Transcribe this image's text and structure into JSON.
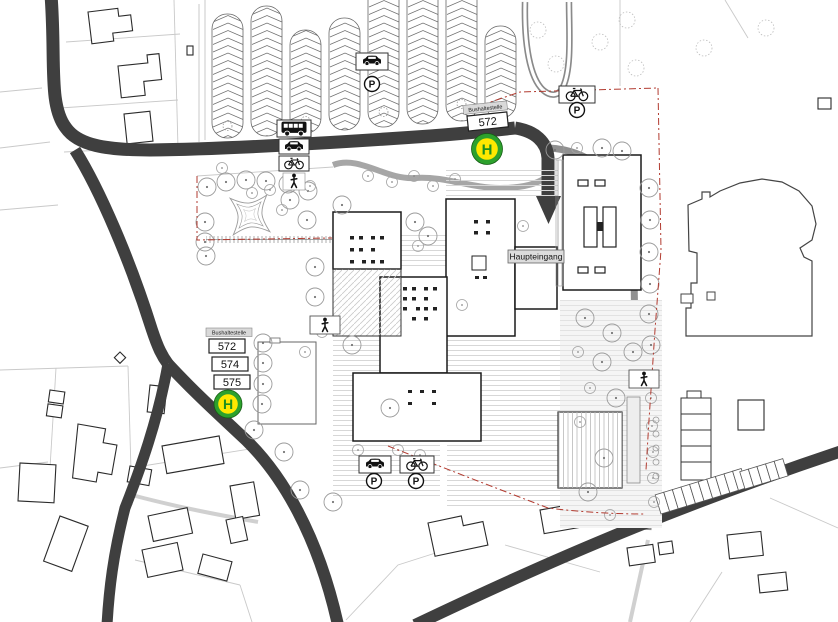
{
  "map": {
    "labels": {
      "main_entrance": "Haupteingang"
    },
    "bus_stops": [
      {
        "location": "north-main-entrance",
        "caption": "Bushaltestelle",
        "lines": [
          "572"
        ],
        "sign": "H"
      },
      {
        "location": "west-road",
        "caption": "Bushaltestelle",
        "lines": [
          "572",
          "574",
          "575"
        ],
        "sign": "H"
      }
    ],
    "parking_sign": "P",
    "icons": {
      "bus": "bus-icon",
      "car": "car-icon",
      "bicycle": "bicycle-icon",
      "pedestrian": "pedestrian-icon",
      "parking": "parking-p-icon",
      "bus_stop": "bus-stop-h-icon"
    },
    "colors": {
      "road": "#3f3f3f",
      "path_gray": "#8f8f8f",
      "stop_green": "#2da12d",
      "stop_yellow": "#ffe800",
      "stop_letter_green": "#1e8f1e",
      "boundary_red": "#b23b30"
    }
  }
}
